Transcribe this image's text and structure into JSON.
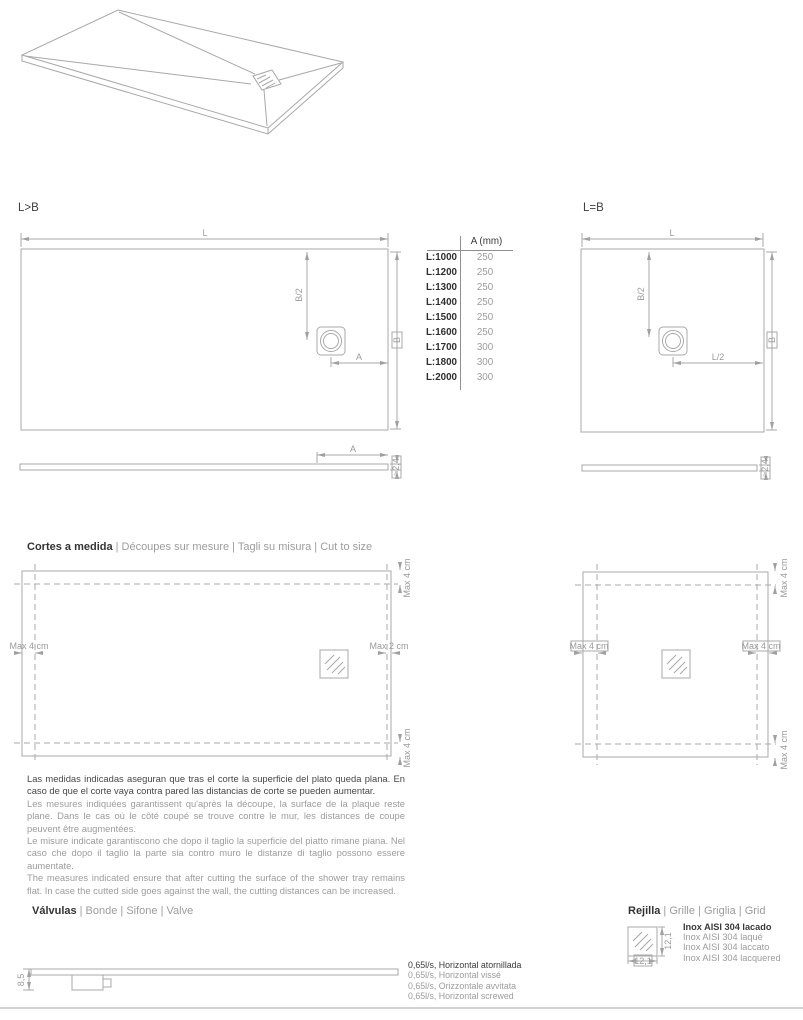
{
  "diagrams": {
    "lgtb": {
      "title": "L>B",
      "dim_l": "L",
      "dim_b2": "B/2",
      "dim_a": "A",
      "dim_b": "B"
    },
    "leqb": {
      "title": "L=B",
      "dim_l": "L",
      "dim_b2": "B/2",
      "dim_l2": "L/2",
      "dim_b": "B"
    },
    "profile_left": {
      "dim_a": "A",
      "dim_thickness": "≈2,4"
    },
    "profile_right": {
      "dim_thickness": "≈2,4"
    }
  },
  "size_table": {
    "header": "A (mm)",
    "rows": [
      {
        "length": "L:1000",
        "a": "250"
      },
      {
        "length": "L:1200",
        "a": "250"
      },
      {
        "length": "L:1300",
        "a": "250"
      },
      {
        "length": "L:1400",
        "a": "250"
      },
      {
        "length": "L:1500",
        "a": "250"
      },
      {
        "length": "L:1600",
        "a": "250"
      },
      {
        "length": "L:1700",
        "a": "300"
      },
      {
        "length": "L:1800",
        "a": "300"
      },
      {
        "length": "L:2000",
        "a": "300"
      }
    ]
  },
  "cut_section": {
    "heading_main": "Cortes a medida",
    "heading_translations": "| Découpes sur mesure | Tagli su misura | Cut to size",
    "left_diagram": {
      "label_left": "Max 4 cm",
      "label_right": "Max 2 cm",
      "label_top": "Max 4 cm",
      "label_bottom": "Max 4 cm"
    },
    "right_diagram": {
      "label_left": "Max 4 cm",
      "label_right": "Max 4 cm",
      "label_top": "Max 4 cm",
      "label_bottom": "Max 4 cm"
    },
    "notes_es": "Las medidas indicadas aseguran que tras el corte la superficie del plato queda plana. En caso de que el corte vaya contra pared las distancias de corte se pueden aumentar.",
    "notes_fr": "Les mesures indiquées garantissent qu'après la découpe, la surface de la plaque reste plane. Dans le cas où le côté coupé se trouve contre le mur, les distances de coupe peuvent être augmentées.",
    "notes_it": "Le misure indicate garantiscono che dopo il taglio la superficie del piatto rimane piana. Nel caso che dopo il taglio la parte sia contro muro le distanze di taglio possono essere aumentate.",
    "notes_en": "The measures indicated ensure that after cutting the surface of the shower tray remains flat. In case the cutted side goes against the wall, the cutting distances can be increased."
  },
  "valve_section": {
    "heading_main": "Válvulas",
    "heading_translations": "| Bonde | Sifone | Valve",
    "dim_height": "8,5",
    "specs": [
      "0,65l/s, Horizontal atornillada",
      "0,65l/s, Horizontal vissé",
      "0,65l/s, Orizzontale avvitata",
      "0,65l/s, Horizontal screwed"
    ]
  },
  "grid_section": {
    "heading_main": "Rejilla",
    "heading_translations": "| Grille | Griglia | Grid",
    "dim_width": "12,1",
    "dim_height": "12,1",
    "specs": [
      "Inox AISI 304 lacado",
      "Inox AISI 304 laqué",
      "Inox AISI 304 laccato",
      "Inox AISI 304 lacquered"
    ]
  },
  "colors": {
    "line": "#a8a8a8",
    "dark_text": "#3a3a3a",
    "gray_text": "#9c9c9c"
  }
}
